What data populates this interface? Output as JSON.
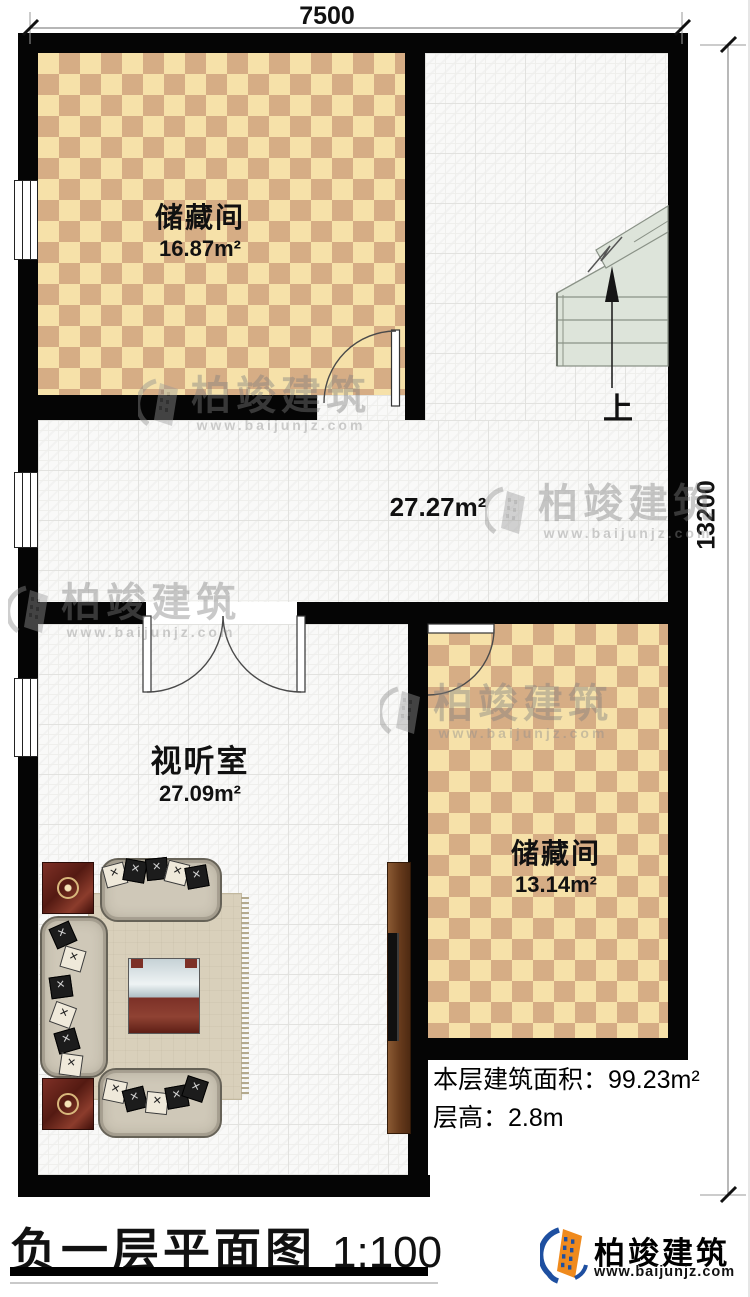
{
  "dimensions": {
    "top": "7500",
    "right": "13200"
  },
  "rooms": {
    "storage1": {
      "name": "储藏间",
      "area": "16.87m²"
    },
    "hall": {
      "area": "27.27m²"
    },
    "av_room": {
      "name": "视听室",
      "area": "27.09m²"
    },
    "storage2": {
      "name": "储藏间",
      "area": "13.14m²"
    }
  },
  "stairs": {
    "label": "上"
  },
  "info": {
    "floor_area": "本层建筑面积：99.23m²",
    "floor_height": "层高：2.8m"
  },
  "title": {
    "name": "负一层平面图",
    "scale": "1:100"
  },
  "watermark": {
    "name": "柏竣建筑",
    "url": "www.baijunjz.com"
  },
  "brand": {
    "name": "柏竣建筑",
    "url": "www.baijunjz.com"
  },
  "colors": {
    "wall": "#050505",
    "checker_light": "#f6e1a9",
    "checker_dark": "#d6ad85",
    "stair_fill": "#dde4da",
    "glass": "#cfd9dc",
    "wood_red": "#7c3027",
    "brand_blue": "#1e4fa0",
    "brand_orange": "#ef8a1d"
  }
}
